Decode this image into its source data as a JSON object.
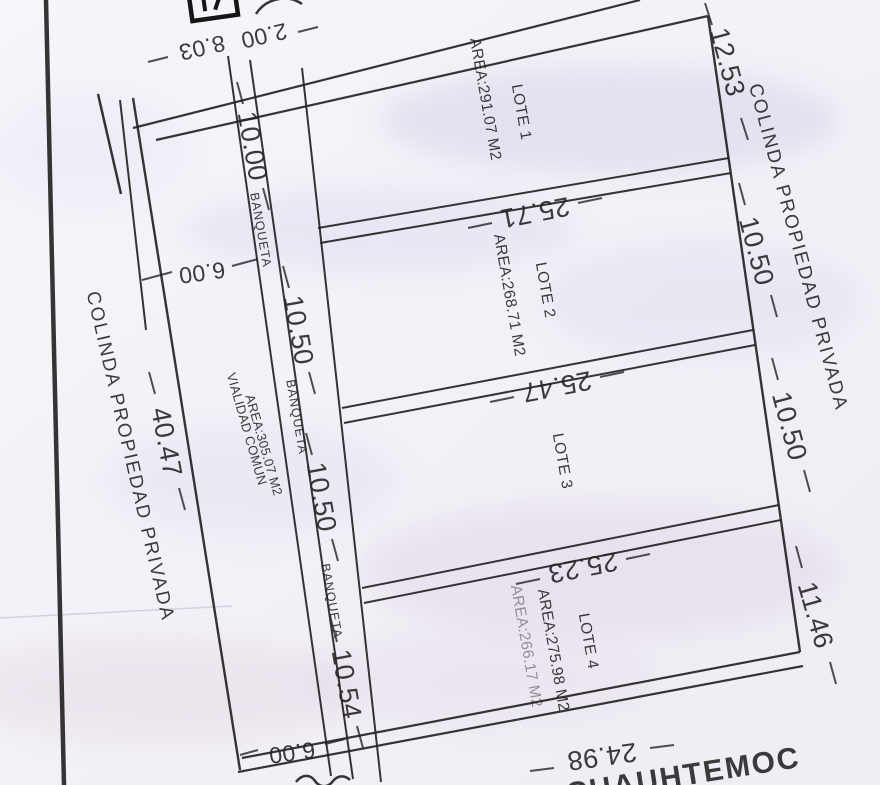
{
  "colors": {
    "ink": "#242424",
    "paper": "#f5f3f8"
  },
  "lots": {
    "lote1": {
      "name": "LOTE 1",
      "area": "AREA:291.07 M2"
    },
    "lote2": {
      "name": "LOTE 2",
      "area": "AREA:268.71 M2"
    },
    "lote3": {
      "name": "LOTE 3"
    },
    "lote4": {
      "name": "LOTE 4",
      "area": "AREA:275.98 M2",
      "area_ghost": "AREA:266.17 M2"
    }
  },
  "common_areas": {
    "vialidad_line1": "VIALIDAD COMUN",
    "vialidad_line2": "AREA:305.07 M2",
    "banqueta": [
      "BANQUETA",
      "BANQUETA",
      "BANQUETA"
    ]
  },
  "boundaries": {
    "colinda_left": "COLINDA PROPIEDAD PRIVADA",
    "colinda_right": "COLINDA PROPIEDAD PRIVADA",
    "street_bottom": "D CUAUHTEMOC"
  },
  "dimensions": {
    "top_a": "8.03",
    "top_b": "2.00",
    "left_pocket": "6.00",
    "bottom_pocket": "6.00",
    "left_side": "40.47",
    "right_top": "12.53",
    "right_mid1": "10.50",
    "right_mid2": "10.50",
    "right_low": "11.46",
    "strip": [
      "10.00",
      "10.50",
      "10.50",
      "10.54"
    ],
    "div1": "25.71",
    "div2": "25.47",
    "div3": "25.23",
    "bottom": "24.98"
  }
}
